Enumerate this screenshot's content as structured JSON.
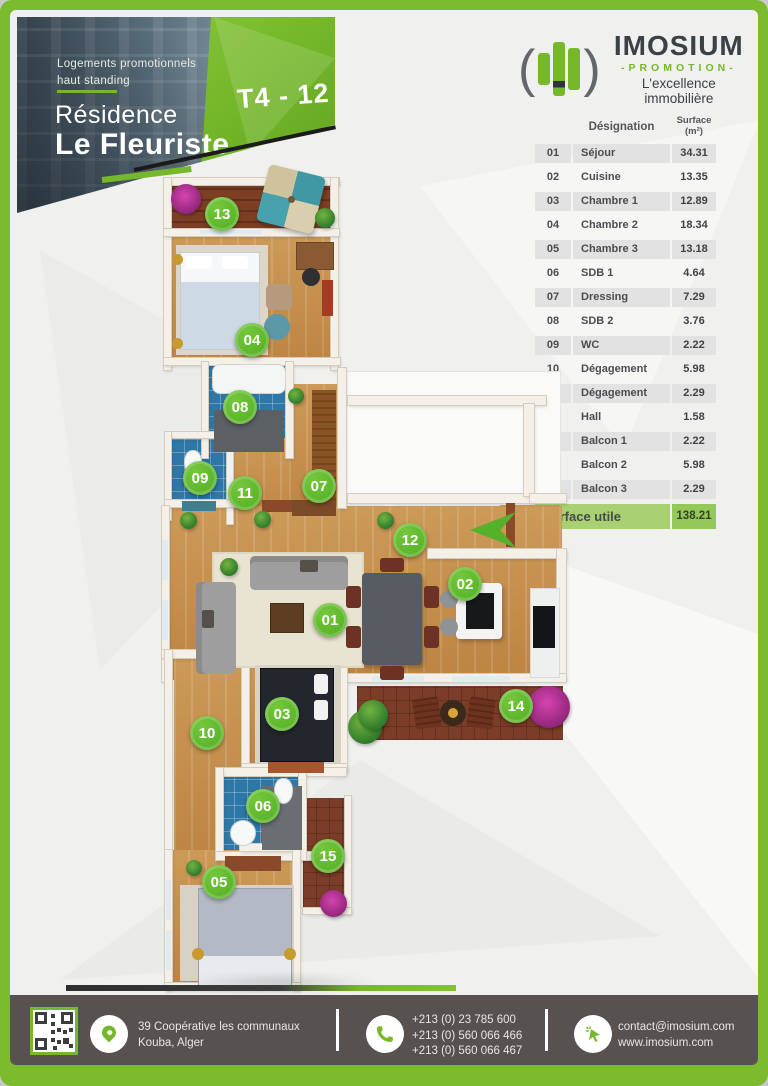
{
  "header": {
    "tagline_line1": "Logements promotionnels",
    "tagline_line2": "haut standing",
    "title_line1": "Résidence",
    "title_line2": "Le Fleuriste",
    "unit_badge": "T4 - 12"
  },
  "brand": {
    "paren_left": "(",
    "paren_right": ")",
    "name": "IMOSIUM",
    "promotion": "-PROMOTION-",
    "slogan": "L'excellence immobilière",
    "logo_icon": "building-bars-icon"
  },
  "surface_table": {
    "header_designation": "Désignation",
    "header_surface_line1": "Surface",
    "header_surface_line2": "(m²)",
    "rows": [
      {
        "num": "01",
        "label": "Séjour",
        "value": "34.31"
      },
      {
        "num": "02",
        "label": "Cuisine",
        "value": "13.35"
      },
      {
        "num": "03",
        "label": "Chambre 1",
        "value": "12.89"
      },
      {
        "num": "04",
        "label": "Chambre 2",
        "value": "18.34"
      },
      {
        "num": "05",
        "label": "Chambre 3",
        "value": "13.18"
      },
      {
        "num": "06",
        "label": "SDB 1",
        "value": "4.64"
      },
      {
        "num": "07",
        "label": "Dressing",
        "value": "7.29"
      },
      {
        "num": "08",
        "label": "SDB 2",
        "value": "3.76"
      },
      {
        "num": "09",
        "label": "WC",
        "value": "2.22"
      },
      {
        "num": "10",
        "label": "Dégagement",
        "value": "5.98"
      },
      {
        "num": "11",
        "label": "Dégagement",
        "value": "2.29"
      },
      {
        "num": "12",
        "label": "Hall",
        "value": "1.58"
      },
      {
        "num": "13",
        "label": "Balcon 1",
        "value": "2.22"
      },
      {
        "num": "14",
        "label": "Balcon 2",
        "value": "5.98"
      },
      {
        "num": "15",
        "label": "Balcon 3",
        "value": "2.29"
      }
    ],
    "total_label": "Surface utile",
    "total_value": "138.21"
  },
  "plan": {
    "markers": [
      {
        "num": "01",
        "label": "Séjour",
        "x": 330,
        "y": 620
      },
      {
        "num": "02",
        "label": "Cuisine",
        "x": 465,
        "y": 584
      },
      {
        "num": "03",
        "label": "Chambre 1",
        "x": 282,
        "y": 714
      },
      {
        "num": "04",
        "label": "Chambre 2",
        "x": 252,
        "y": 340
      },
      {
        "num": "05",
        "label": "Chambre 3",
        "x": 219,
        "y": 882
      },
      {
        "num": "06",
        "label": "SDB 1",
        "x": 263,
        "y": 806
      },
      {
        "num": "07",
        "label": "Dressing",
        "x": 319,
        "y": 486
      },
      {
        "num": "08",
        "label": "SDB 2",
        "x": 240,
        "y": 407
      },
      {
        "num": "09",
        "label": "WC",
        "x": 200,
        "y": 478
      },
      {
        "num": "10",
        "label": "Dégagement",
        "x": 207,
        "y": 733
      },
      {
        "num": "11",
        "label": "Dégagement",
        "x": 245,
        "y": 493
      },
      {
        "num": "12",
        "label": "Hall",
        "x": 410,
        "y": 540
      },
      {
        "num": "13",
        "label": "Balcon 1",
        "x": 222,
        "y": 214
      },
      {
        "num": "14",
        "label": "Balcon 2",
        "x": 516,
        "y": 706
      },
      {
        "num": "15",
        "label": "Balcon 3",
        "x": 328,
        "y": 856
      }
    ],
    "entrance_icon": "entrance-arrow-icon"
  },
  "footer": {
    "address_line1": "39 Coopérative les communaux",
    "address_line2": "Kouba, Alger",
    "phones": [
      "+213  (0)  23 785 600",
      "+213 (0) 560 066 466",
      "+213 (0) 560 066 467"
    ],
    "email": "contact@imosium.com",
    "website": "www.imosium.com"
  },
  "colors": {
    "accent_green": "#76b82a",
    "footer_bg": "#575150",
    "table_total_green": "#94c957",
    "table_row_gray": "#e2e2e2"
  }
}
